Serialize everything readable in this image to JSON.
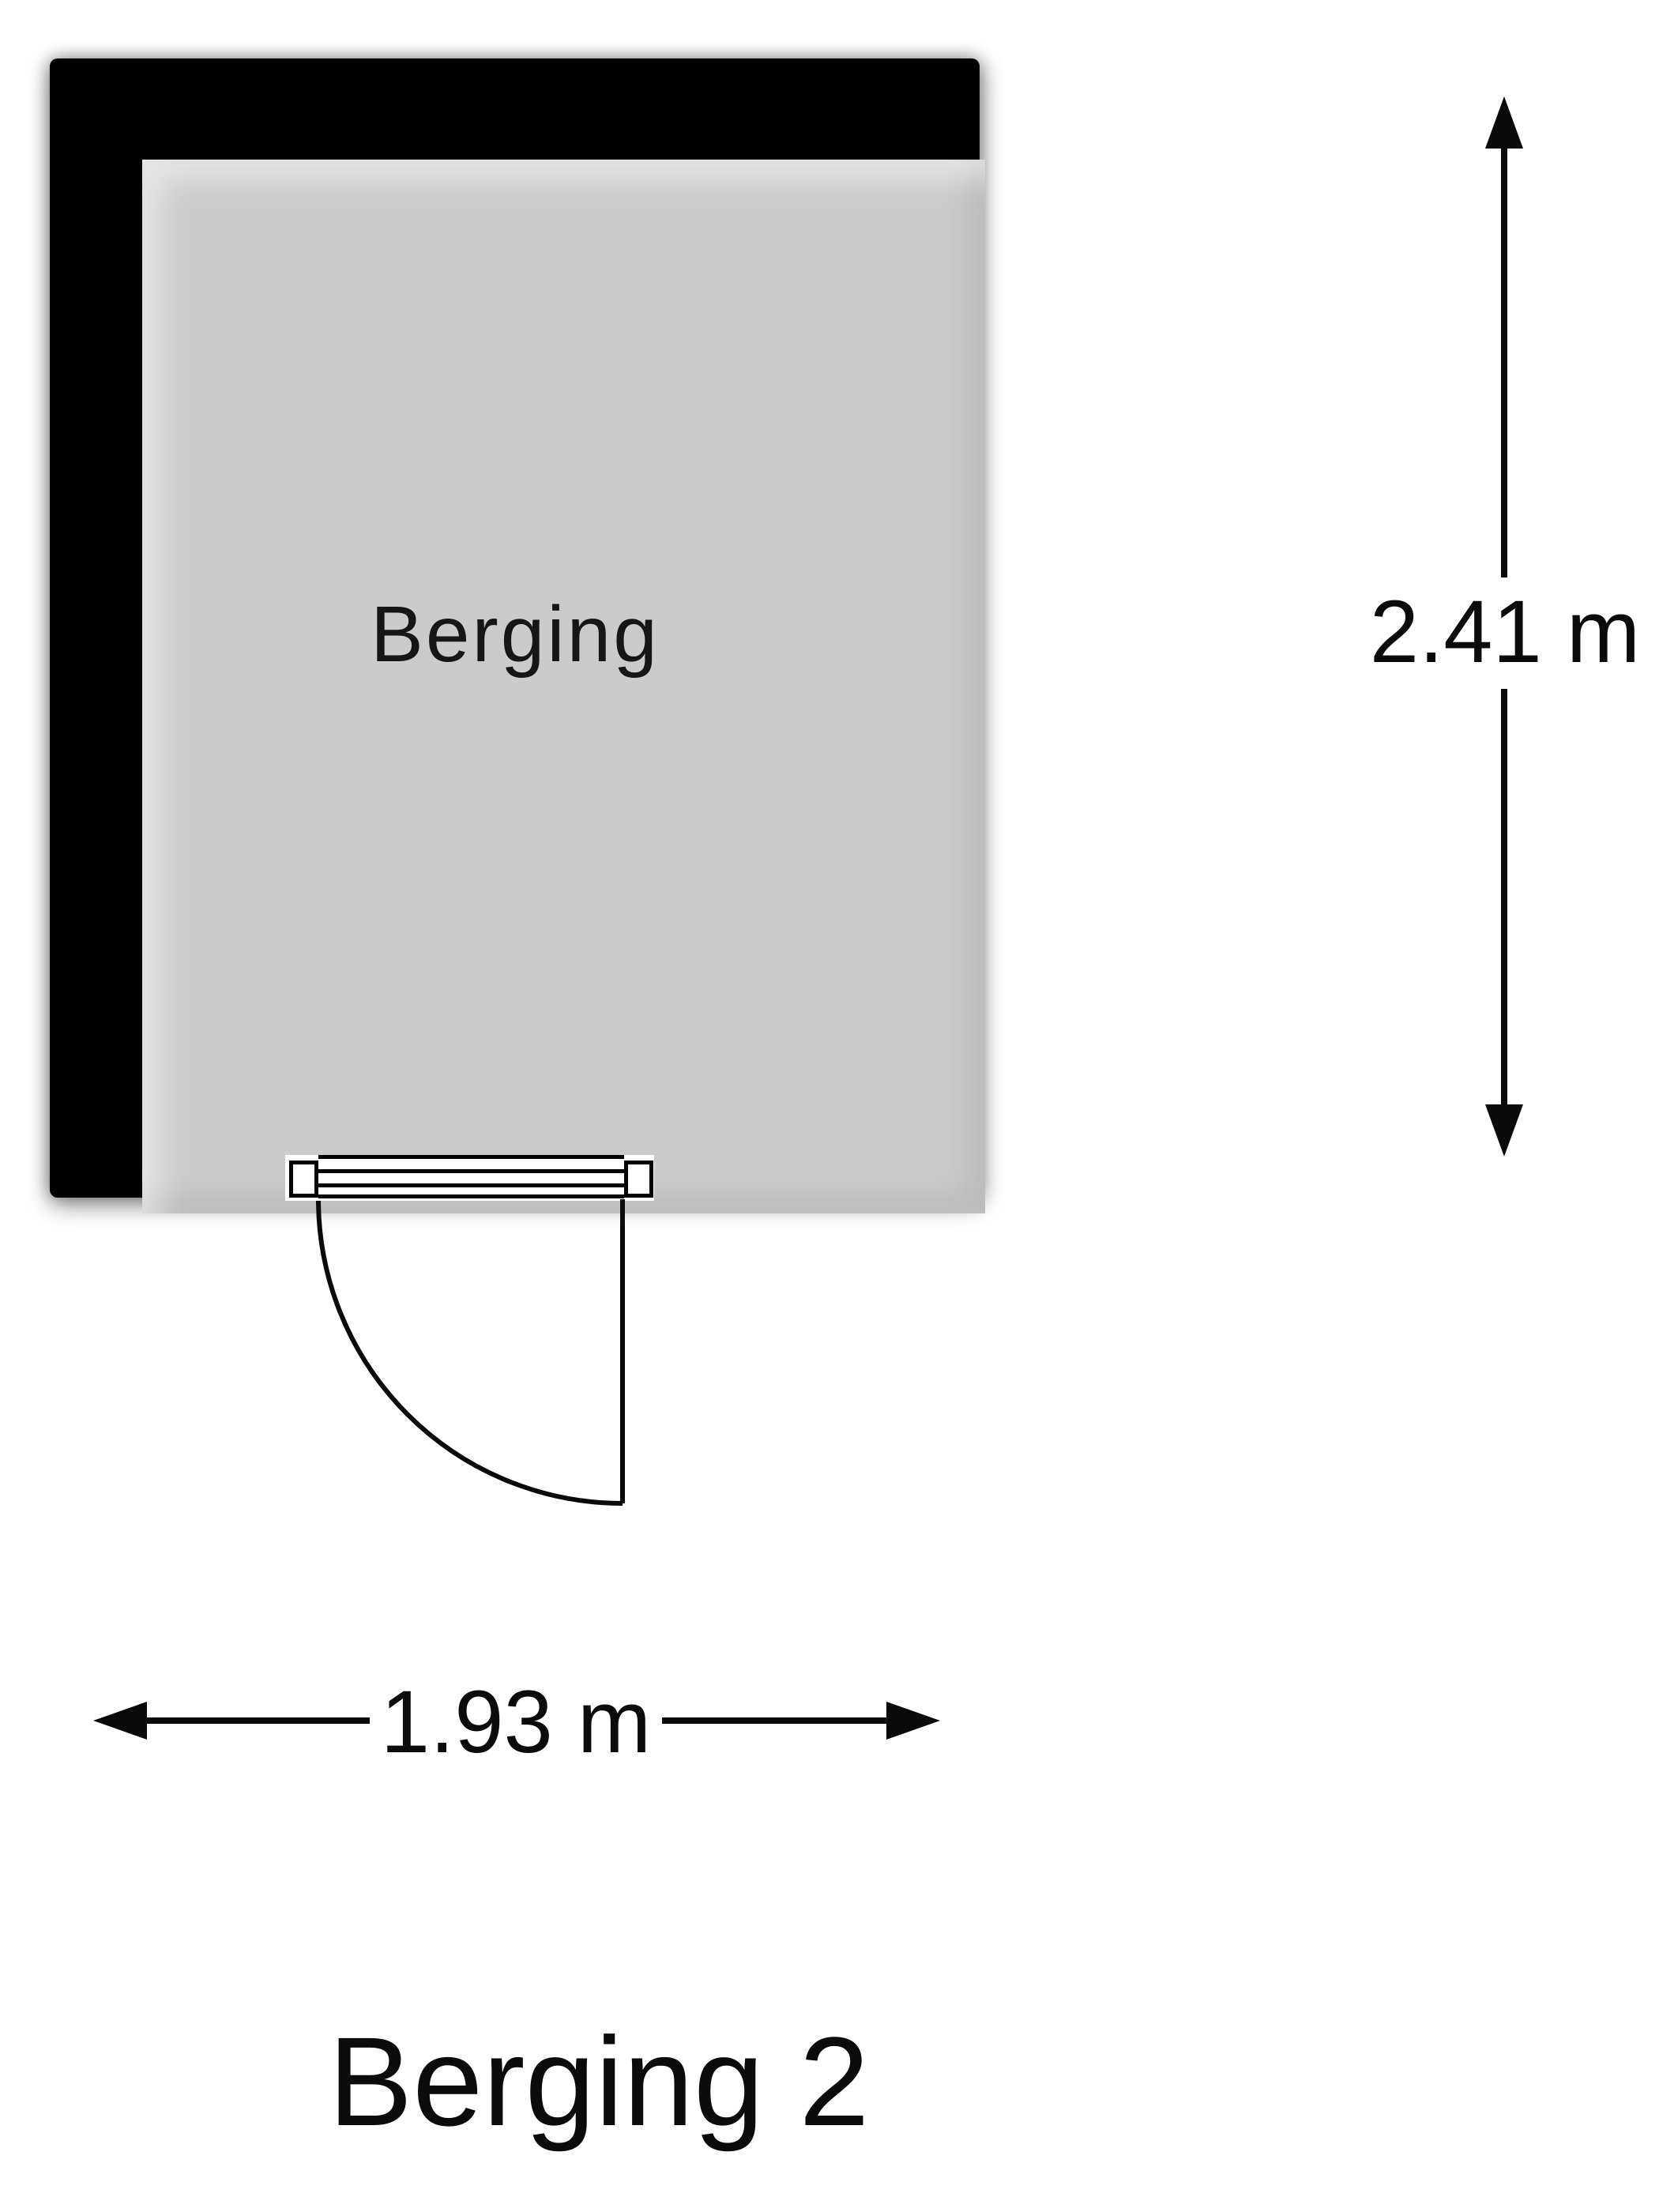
{
  "floorplan": {
    "room_label": "Berging",
    "height_dimension": "2.41 m",
    "width_dimension": "1.93 m",
    "title": "Berging 2"
  },
  "colors": {
    "wall": "#000000",
    "floor": "#cbcbcb",
    "background": "#ffffff",
    "line": "#0a0a0a",
    "text": "#0b0b0b"
  }
}
